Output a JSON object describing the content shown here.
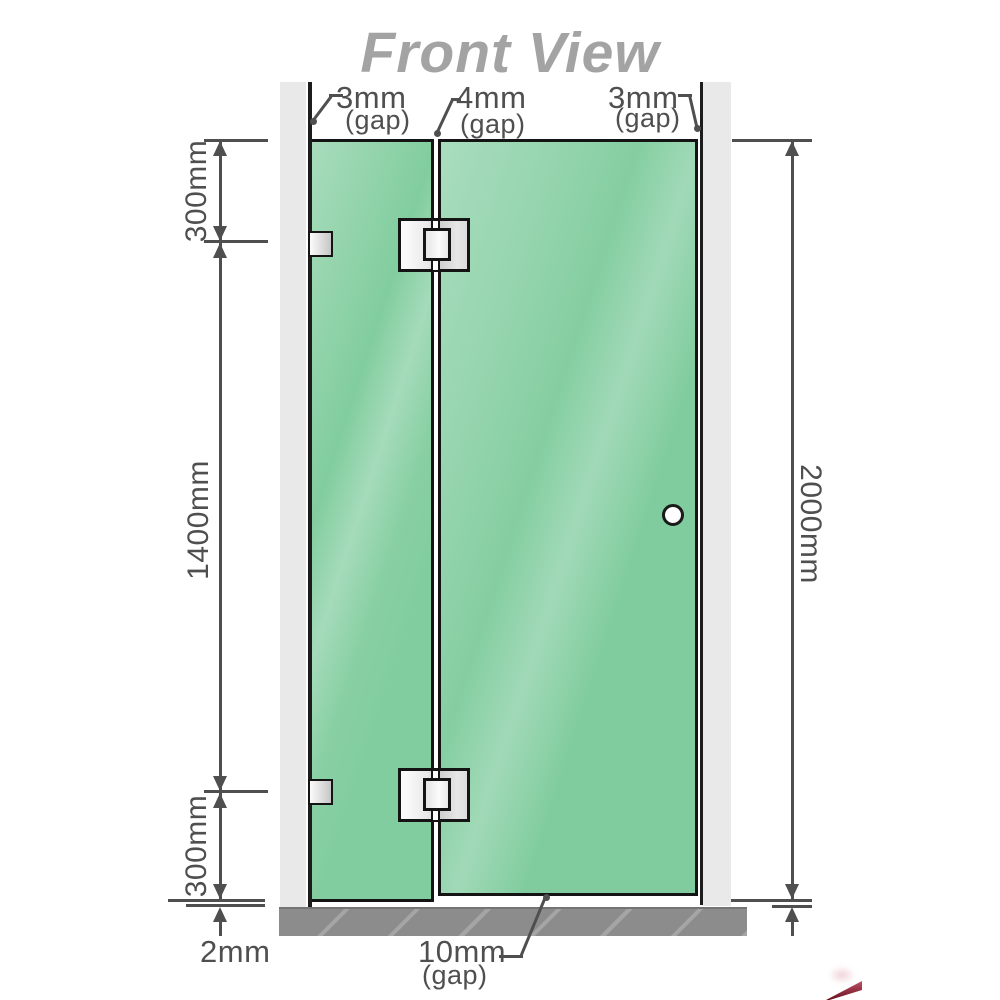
{
  "title": "Front View",
  "top_gap_labels": [
    {
      "value": "3mm",
      "suffix": "(gap)"
    },
    {
      "value": "4mm",
      "suffix": "(gap)"
    },
    {
      "value": "3mm",
      "suffix": "(gap)"
    }
  ],
  "left_dimensions": {
    "top": "300mm",
    "middle": "1400mm",
    "bottom": "300mm",
    "floor_clearance": "2mm"
  },
  "right_dimension": {
    "overall_height": "2000mm"
  },
  "bottom_gap": {
    "value": "10mm",
    "suffix": "(gap)"
  },
  "colors": {
    "glass": "#82cd9f",
    "glass_highlight": "#a9e0bd",
    "glass_border": "#141414",
    "wall": "#e9e9e9",
    "wall_edge_line": "#1d1d1d",
    "floor": "#8c8c8c",
    "floor_hatch": "#a8a8a8",
    "dimension": "#4f4f4f",
    "title": "#a3a3a3",
    "hinge_metal_light": "#fafafa",
    "hinge_metal_dark": "#d0d0d0",
    "watermark_red": "#7d1326"
  }
}
